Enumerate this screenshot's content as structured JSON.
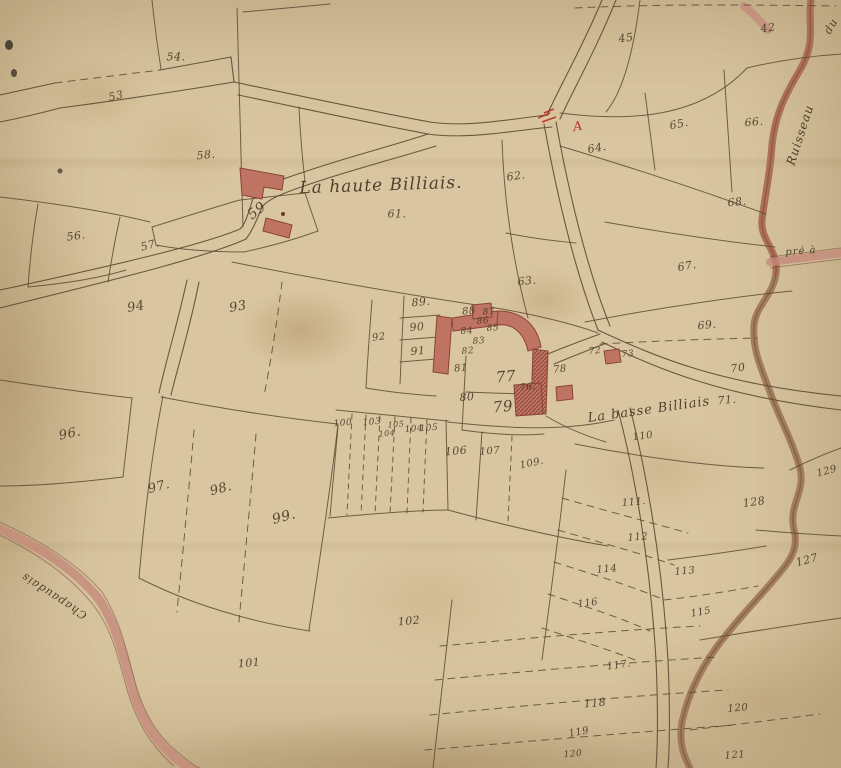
{
  "map": {
    "type": "antique-cadastral-map",
    "hamlet_north": "La haute Billiais.",
    "hamlet_south": "La basse Billiais"
  },
  "palette": {
    "parchment": "#d9c6a0",
    "ink": "#5d4a33",
    "label_ink": "#453524",
    "building_red": "#bf7463",
    "building_dark": "#8a4435",
    "stream_brown": "#9a7153",
    "stream_red": "#b06b54",
    "road_red": "#c4897a",
    "accent_red": "#b5281e"
  },
  "place_labels": [
    {
      "id": "la-haute-billiais",
      "text": "La haute Billiais.",
      "x": 381,
      "y": 186,
      "size": 17,
      "rot": -2
    },
    {
      "id": "la-basse-billiais",
      "text": "La basse Billiais",
      "x": 649,
      "y": 410,
      "size": 13,
      "rot": -8
    },
    {
      "id": "ruisseau",
      "text": "Ruisseau",
      "x": 800,
      "y": 135,
      "size": 12,
      "rot": -72
    },
    {
      "id": "ruisseau-du",
      "text": "du",
      "x": 831,
      "y": 26,
      "size": 11,
      "rot": -60
    },
    {
      "id": "pre-a",
      "text": "pré à",
      "x": 801,
      "y": 252,
      "size": 10,
      "rot": -4
    },
    {
      "id": "chapaudais",
      "text": "Chapaudais",
      "x": 54,
      "y": 596,
      "size": 11,
      "rot": 213
    }
  ],
  "marks": [
    {
      "id": "red-letter-a",
      "text": "A",
      "x": 578,
      "y": 127,
      "size": 13,
      "rot": -10,
      "color": "#b5281e"
    }
  ],
  "parcels": [
    {
      "n": "53",
      "x": 116,
      "y": 96,
      "rot": -12
    },
    {
      "n": "54.",
      "x": 176,
      "y": 57,
      "rot": 0
    },
    {
      "n": "45",
      "x": 626,
      "y": 38,
      "rot": -8
    },
    {
      "n": "42",
      "x": 768,
      "y": 28,
      "rot": -8
    },
    {
      "n": "58.",
      "x": 206,
      "y": 155,
      "rot": -5
    },
    {
      "n": "59",
      "x": 257,
      "y": 211,
      "rot": -38,
      "size": 14
    },
    {
      "n": "56.",
      "x": 76,
      "y": 236,
      "rot": -8
    },
    {
      "n": "57.",
      "x": 150,
      "y": 245,
      "rot": -15
    },
    {
      "n": "61.",
      "x": 397,
      "y": 214,
      "rot": 0
    },
    {
      "n": "62.",
      "x": 516,
      "y": 176,
      "rot": -8
    },
    {
      "n": "63.",
      "x": 527,
      "y": 281,
      "rot": -5
    },
    {
      "n": "64.",
      "x": 597,
      "y": 148,
      "rot": -10
    },
    {
      "n": "65.",
      "x": 679,
      "y": 124,
      "rot": -12
    },
    {
      "n": "66.",
      "x": 754,
      "y": 122,
      "rot": -5
    },
    {
      "n": "68.",
      "x": 737,
      "y": 202,
      "rot": -5
    },
    {
      "n": "67.",
      "x": 687,
      "y": 266,
      "rot": -10
    },
    {
      "n": "69.",
      "x": 707,
      "y": 325,
      "rot": -5
    },
    {
      "n": "70",
      "x": 738,
      "y": 368,
      "rot": -8
    },
    {
      "n": "71.",
      "x": 727,
      "y": 400,
      "rot": -5
    },
    {
      "n": "72",
      "x": 595,
      "y": 352,
      "rot": -5,
      "size": 9
    },
    {
      "n": "73",
      "x": 628,
      "y": 355,
      "rot": -5,
      "size": 9
    },
    {
      "n": "88",
      "x": 469,
      "y": 312,
      "rot": -5,
      "size": 10
    },
    {
      "n": "87",
      "x": 489,
      "y": 313,
      "rot": -5,
      "size": 9
    },
    {
      "n": "86",
      "x": 483,
      "y": 322,
      "rot": -5,
      "size": 9
    },
    {
      "n": "85",
      "x": 493,
      "y": 329,
      "rot": -5,
      "size": 9
    },
    {
      "n": "84",
      "x": 467,
      "y": 332,
      "rot": -5,
      "size": 9
    },
    {
      "n": "83",
      "x": 479,
      "y": 342,
      "rot": -5,
      "size": 9
    },
    {
      "n": "82",
      "x": 468,
      "y": 352,
      "rot": -5,
      "size": 9
    },
    {
      "n": "81",
      "x": 461,
      "y": 369,
      "rot": -5,
      "size": 10
    },
    {
      "n": "80",
      "x": 467,
      "y": 397,
      "rot": -5
    },
    {
      "n": "76.",
      "x": 528,
      "y": 388,
      "rot": -5,
      "size": 9
    },
    {
      "n": "77",
      "x": 506,
      "y": 377,
      "rot": -5,
      "size": 15
    },
    {
      "n": "78",
      "x": 560,
      "y": 370,
      "rot": -5,
      "size": 10
    },
    {
      "n": "79",
      "x": 503,
      "y": 407,
      "rot": -5,
      "size": 15
    },
    {
      "n": "89.",
      "x": 421,
      "y": 302,
      "rot": -5
    },
    {
      "n": "90",
      "x": 417,
      "y": 327,
      "rot": -5
    },
    {
      "n": "91",
      "x": 418,
      "y": 351,
      "rot": -5
    },
    {
      "n": "92",
      "x": 379,
      "y": 338,
      "rot": -8,
      "size": 10
    },
    {
      "n": "93",
      "x": 238,
      "y": 307,
      "rot": -10,
      "size": 13
    },
    {
      "n": "94",
      "x": 136,
      "y": 307,
      "rot": -10,
      "size": 13
    },
    {
      "n": "96.",
      "x": 70,
      "y": 434,
      "rot": -12,
      "size": 13
    },
    {
      "n": "97.",
      "x": 159,
      "y": 487,
      "rot": -15,
      "size": 13
    },
    {
      "n": "98.",
      "x": 221,
      "y": 489,
      "rot": -15,
      "size": 13
    },
    {
      "n": "99.",
      "x": 284,
      "y": 517,
      "rot": -15,
      "size": 14
    },
    {
      "n": "100",
      "x": 343,
      "y": 424,
      "rot": -5,
      "size": 9
    },
    {
      "n": "103",
      "x": 372,
      "y": 423,
      "rot": -5,
      "size": 9
    },
    {
      "n": "104",
      "x": 387,
      "y": 434,
      "rot": -5,
      "size": 8
    },
    {
      "n": "105",
      "x": 396,
      "y": 425,
      "rot": -5,
      "size": 8
    },
    {
      "n": "104",
      "x": 414,
      "y": 430,
      "rot": -5,
      "size": 9
    },
    {
      "n": "105",
      "x": 429,
      "y": 429,
      "rot": -5,
      "size": 9
    },
    {
      "n": "106",
      "x": 456,
      "y": 451,
      "rot": -5
    },
    {
      "n": "107",
      "x": 490,
      "y": 452,
      "rot": -5,
      "size": 10
    },
    {
      "n": "109.",
      "x": 532,
      "y": 464,
      "rot": -12,
      "size": 10
    },
    {
      "n": "110",
      "x": 643,
      "y": 437,
      "rot": -8,
      "size": 10
    },
    {
      "n": "101",
      "x": 249,
      "y": 663,
      "rot": -5
    },
    {
      "n": "102",
      "x": 409,
      "y": 621,
      "rot": -5
    },
    {
      "n": "111.",
      "x": 634,
      "y": 503,
      "rot": -5,
      "size": 10
    },
    {
      "n": "112",
      "x": 638,
      "y": 538,
      "rot": -5,
      "size": 10
    },
    {
      "n": "114",
      "x": 607,
      "y": 570,
      "rot": -5,
      "size": 10
    },
    {
      "n": "113",
      "x": 685,
      "y": 572,
      "rot": -5,
      "size": 10
    },
    {
      "n": "116",
      "x": 588,
      "y": 604,
      "rot": -8,
      "size": 10
    },
    {
      "n": "115",
      "x": 701,
      "y": 613,
      "rot": -10,
      "size": 10
    },
    {
      "n": "117.",
      "x": 619,
      "y": 666,
      "rot": -8,
      "size": 10
    },
    {
      "n": "118",
      "x": 595,
      "y": 703,
      "rot": -5,
      "size": 11
    },
    {
      "n": "119",
      "x": 579,
      "y": 733,
      "rot": -10,
      "size": 10
    },
    {
      "n": "120",
      "x": 573,
      "y": 755,
      "rot": -5,
      "size": 9
    },
    {
      "n": "120",
      "x": 738,
      "y": 709,
      "rot": -5,
      "size": 10
    },
    {
      "n": "121",
      "x": 735,
      "y": 756,
      "rot": -5,
      "size": 10
    },
    {
      "n": "127",
      "x": 807,
      "y": 560,
      "rot": -15,
      "size": 11
    },
    {
      "n": "128",
      "x": 754,
      "y": 502,
      "rot": -8,
      "size": 11
    },
    {
      "n": "129",
      "x": 827,
      "y": 472,
      "rot": -15,
      "size": 10
    }
  ]
}
